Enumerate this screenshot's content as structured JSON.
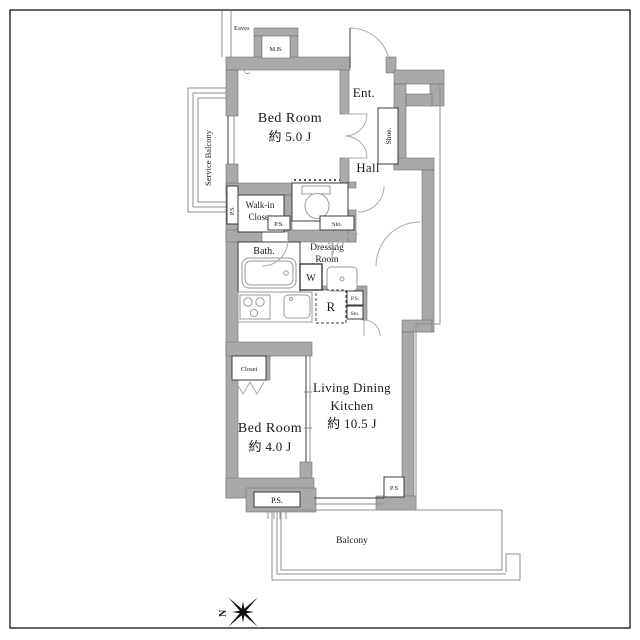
{
  "rooms": {
    "bedroom1": {
      "name": "Bed Room",
      "area": "約 5.0 J"
    },
    "entrance": {
      "label": "Ent."
    },
    "hall": {
      "label": "Hall"
    },
    "shoe": {
      "label": "Shoe."
    },
    "walkin_closet": {
      "line1": "Walk-in",
      "line2": "Closet"
    },
    "bath": {
      "label": "Bath."
    },
    "dressing_room": {
      "line1": "Dressing",
      "line2": "Room"
    },
    "ldk": {
      "line1": "Living Dining",
      "line2": "Kitchen",
      "area": "約 10.5 J"
    },
    "bedroom2": {
      "name": "Bed Room",
      "area": "約 4.0 J"
    },
    "closet": {
      "label": "Closet"
    },
    "balcony": {
      "label": "Balcony"
    },
    "service_balcony": {
      "label": "Service Balcony"
    }
  },
  "fixtures": {
    "washer": "W",
    "fridge": "R"
  },
  "labels": {
    "eaves": "Eaves",
    "eaves_note": "(下り)",
    "meter_box": "M.B.",
    "storage_upper": "Sto.",
    "storage_kitchen": "Sto.",
    "ps_side": "P.S.",
    "ps_walkin": "P.S.",
    "ps_kitchen": "P.S.",
    "ps_bottom_left": "P.S.",
    "ps_bottom_right": "P.S"
  },
  "compass": {
    "north": "N"
  },
  "colors": {
    "wall": "#a9a9a9",
    "outline": "#3c3c3c",
    "thin_line": "#8f8f8f",
    "text": "#1a1a1a",
    "background": "#ffffff"
  }
}
